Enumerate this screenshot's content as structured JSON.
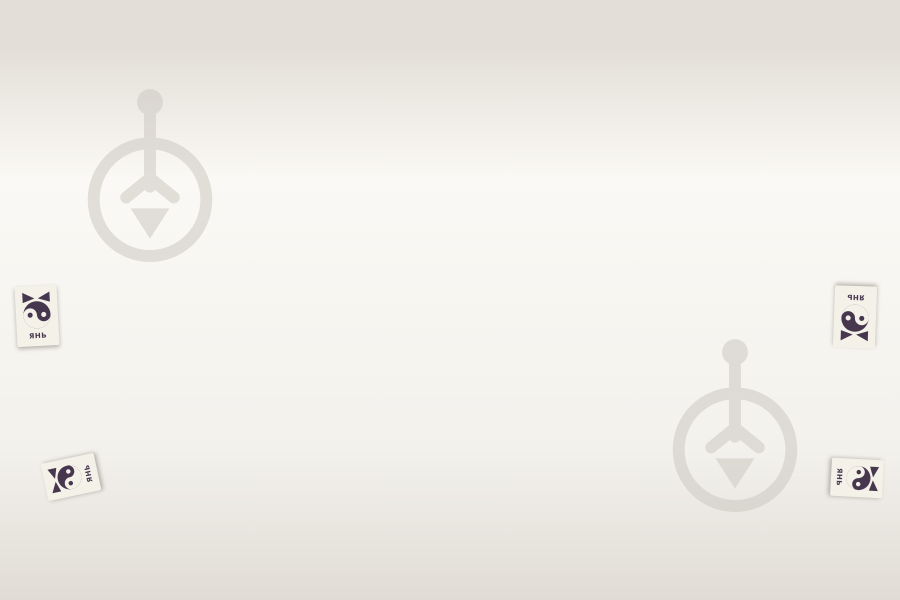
{
  "scene": {
    "subject": "mattress-cutaway-3d-render",
    "background_color": "#ffffff"
  },
  "brand_tag": {
    "label": "ЯНЬ",
    "logo_icon": "cat-yin-yang-icon",
    "logo_color": "#46374f",
    "tag_color": "#f4f1e9",
    "count": 4,
    "positions": [
      "left-side",
      "bottom-left-corner",
      "right-side",
      "bottom-right-corner"
    ]
  },
  "watermark": {
    "icon": "anchor-emblem-watermark-icon",
    "color": "#cdc8c2",
    "opacity": 0.55,
    "count": 2
  },
  "materials": {
    "quilted_cover": "#edeae3",
    "foam_layer": "#ecdcb0",
    "coconut_coir_layer": "#6f3f20",
    "felt_layer": "#8e8d97",
    "pocket_spring_fabric": "#eceae5",
    "spring_wire": "#faf9f6",
    "side_fabric": "#b6b3ad",
    "border_piping": "#f4f2ee",
    "layers_shown": [
      "quilted cover",
      "foam blocks",
      "coconut coir",
      "felt",
      "pocket springs",
      "wadding",
      "bottom cover"
    ]
  }
}
